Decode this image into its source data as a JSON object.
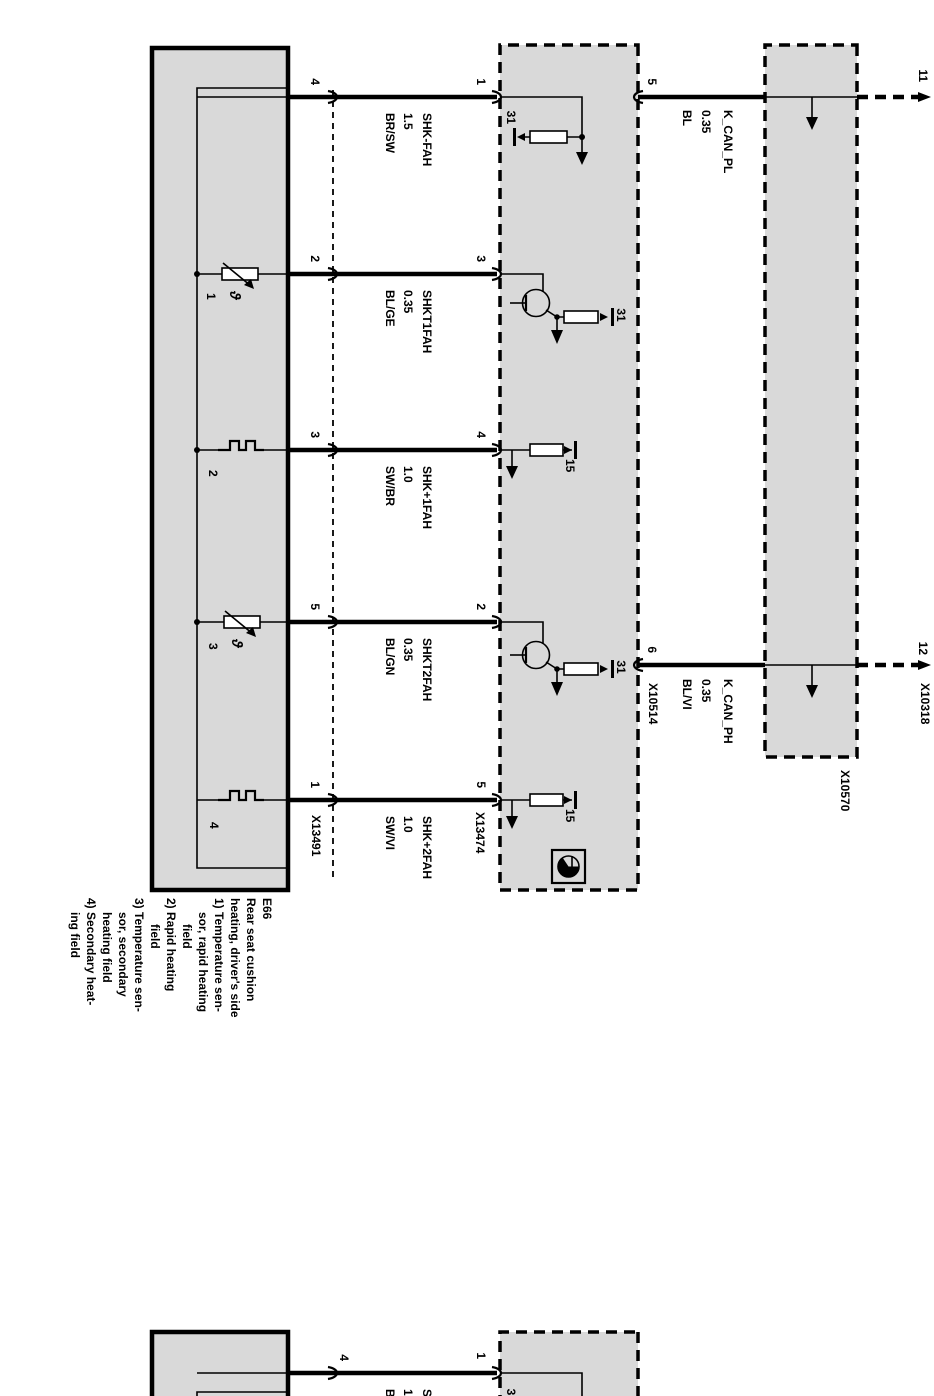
{
  "colors": {
    "box_fill": "#d9d9d9",
    "line": "#000000",
    "background": "#ffffff"
  },
  "component": {
    "legend": [
      "E66",
      "Rear seat cushion",
      "heating, driver's side",
      "1) Temperature sen-",
      "sor, rapid heating",
      "field",
      "2) Rapid heating",
      "field",
      "3) Temperature sen-",
      "sor, secondary",
      "heating field",
      "4) Secondary heat-",
      "ing field"
    ],
    "element_numbers": [
      "1",
      "2",
      "3",
      "4"
    ],
    "theta": "ϑ"
  },
  "wires": [
    {
      "e66_pin": "4",
      "module_pin": "1",
      "name": "SHK-FAH",
      "size": "1.5",
      "color": "BR/SW",
      "terminal": "31"
    },
    {
      "e66_pin": "2",
      "module_pin": "3",
      "name": "SHKT1FAH",
      "size": "0.35",
      "color": "BL/GE",
      "terminal": "31"
    },
    {
      "e66_pin": "3",
      "module_pin": "4",
      "name": "SHK+1FAH",
      "size": "1.0",
      "color": "SW/BR",
      "terminal": "15"
    },
    {
      "e66_pin": "5",
      "module_pin": "2",
      "name": "SHKT2FAH",
      "size": "0.35",
      "color": "BL/GN",
      "terminal": "31"
    },
    {
      "e66_pin": "1",
      "module_pin": "5",
      "name": "SHK+2FAH",
      "size": "1.0",
      "color": "SW/VI",
      "terminal": "15"
    }
  ],
  "can": [
    {
      "module_pin": "5",
      "name": "K_CAN_PL",
      "size": "0.35",
      "color": "BL",
      "sheet_ref": "11"
    },
    {
      "module_pin": "6",
      "name": "K_CAN_PH",
      "size": "0.35",
      "color": "BL/VI",
      "sheet_ref": "12"
    }
  ],
  "connectors": {
    "e66": "X13491",
    "module": "X13474",
    "can_module": "X10514",
    "top_module": "X10570",
    "sheet_edge": "X10318"
  },
  "partial_circuit": {
    "e66_pin": "4",
    "module_pin": "1",
    "terminal": "31",
    "name": "SHK-FAH",
    "size": "1.5",
    "color": "BR/SW"
  }
}
